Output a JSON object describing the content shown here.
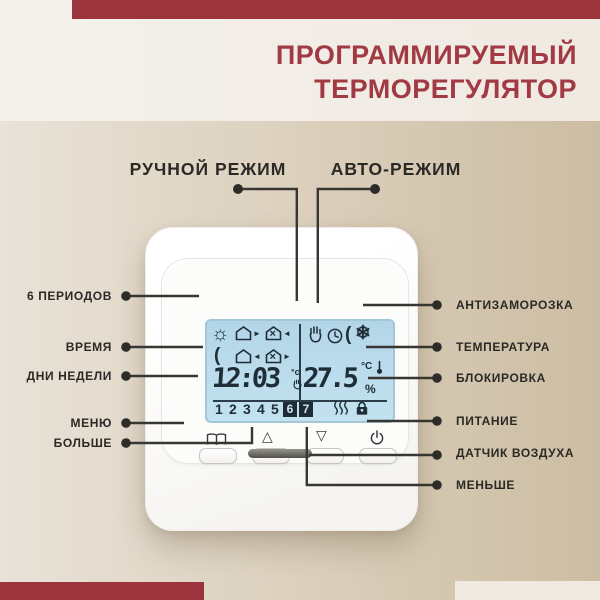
{
  "colors": {
    "accent_red": "#9c343e",
    "lcd_blue": "#badcec",
    "label_dark": "#2b2926"
  },
  "header": {
    "title_line1": "ПРОГРАММИРУЕМЫЙ",
    "title_line2": "ТЕРМОРЕГУЛЯТОР"
  },
  "mode_labels": {
    "manual": "РУЧНОЙ РЕЖИМ",
    "auto": "АВТО-РЕЖИМ"
  },
  "callouts_left": [
    {
      "label": "6 ПЕРИОДОВ"
    },
    {
      "label": "ВРЕМЯ"
    },
    {
      "label": "ДНИ НЕДЕЛИ"
    },
    {
      "label": "МЕНЮ"
    },
    {
      "label": "БОЛЬШЕ"
    }
  ],
  "callouts_right": [
    {
      "label": "АНТИЗАМОРОЗКА"
    },
    {
      "label": "ТЕМПЕРАТУРА"
    },
    {
      "label": "БЛОКИРОВКА"
    },
    {
      "label": "ПИТАНИЕ"
    },
    {
      "label": "ДАТЧИК ВОЗДУХА"
    },
    {
      "label": "МЕНЬШЕ"
    }
  ],
  "display": {
    "time": "12:03",
    "time_unit": "°c",
    "temperature": "27.5",
    "temp_unit": "°C",
    "temp_percent": "%",
    "days": [
      "1",
      "2",
      "3",
      "4",
      "5"
    ],
    "days_active": [
      "6",
      "7"
    ],
    "glyphs": {
      "sun": "☼",
      "moon": "(",
      "snowflake": "❄",
      "arrow_right": "►",
      "arrow_left": "◄",
      "tools": "×"
    },
    "icons_left": [
      "sun",
      "house-leave",
      "house-work",
      "moon",
      "house-return",
      "house-work"
    ],
    "icons_right": [
      "hand-manual",
      "clock-auto",
      "moon-frost",
      "snowflake"
    ],
    "icons_bottom": [
      "heating-waves",
      "lock"
    ]
  },
  "buttons": {
    "up_glyph": "△",
    "down_glyph": "▽",
    "names": [
      "menu",
      "up",
      "down",
      "power"
    ]
  }
}
